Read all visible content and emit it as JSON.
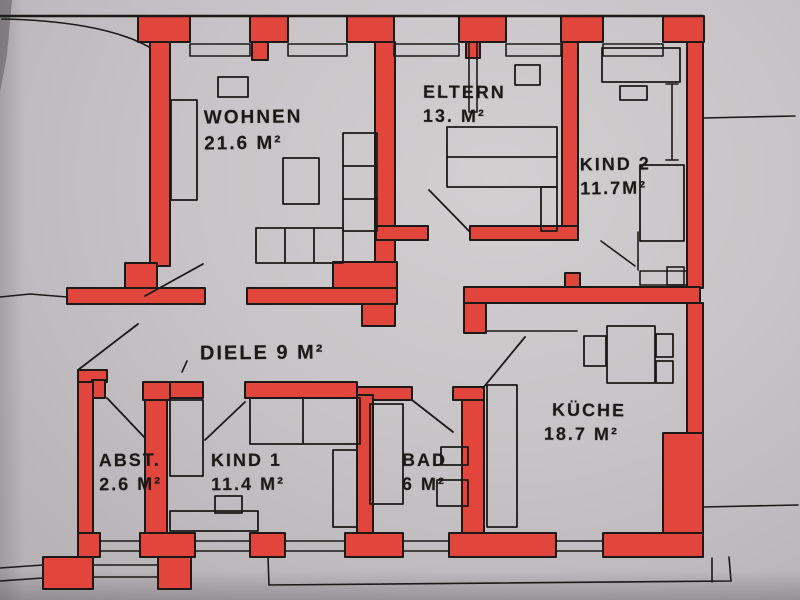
{
  "document": {
    "type": "hand-drawn apartment floor plan, load-bearing walls highlighted red"
  },
  "palette": {
    "wall_red": "#e2453c",
    "line_black": "#1c1a19",
    "paper_gray": "#c7c3c6"
  },
  "rooms": {
    "wohnen": {
      "name": "WOHNEN",
      "area": "21.6 M²"
    },
    "eltern": {
      "name": "ELTERN",
      "area": "13. M²"
    },
    "kind2": {
      "name": "KIND 2",
      "area": "11.7M²"
    },
    "diele": {
      "name": "DIELE 9 M²"
    },
    "kueche": {
      "name": "KÜCHE",
      "area": "18.7 M²"
    },
    "abst": {
      "name": "ABST.",
      "area": "2.6 M²"
    },
    "kind1": {
      "name": "KIND 1",
      "area": "11.4 M²"
    },
    "bad": {
      "name": "BAD",
      "area": "6 M²"
    }
  }
}
